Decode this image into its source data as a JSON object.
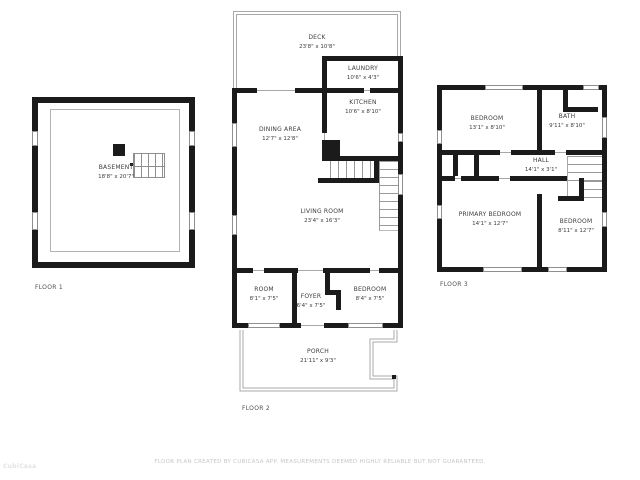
{
  "floors": [
    {
      "label": "FLOOR 1",
      "rooms": [
        {
          "name": "BASEMENT",
          "dims": "18'8\" x 20'7\""
        }
      ]
    },
    {
      "label": "FLOOR 2",
      "rooms": [
        {
          "name": "DECK",
          "dims": "23'8\" x 10'8\""
        },
        {
          "name": "LAUNDRY",
          "dims": "10'6\" x 4'3\""
        },
        {
          "name": "KITCHEN",
          "dims": "10'6\" x 8'10\""
        },
        {
          "name": "DINING AREA",
          "dims": "12'7\" x 12'8\""
        },
        {
          "name": "LIVING ROOM",
          "dims": "23'4\" x 16'3\""
        },
        {
          "name": "ROOM",
          "dims": "8'1\" x 7'5\""
        },
        {
          "name": "FOYER",
          "dims": "6'4\" x 7'5\""
        },
        {
          "name": "BEDROOM",
          "dims": "8'4\" x 7'5\""
        },
        {
          "name": "PORCH",
          "dims": "21'11\" x 9'3\""
        }
      ]
    },
    {
      "label": "FLOOR 3",
      "rooms": [
        {
          "name": "BEDROOM",
          "dims": "13'1\" x 8'10\""
        },
        {
          "name": "BATH",
          "dims": "9'11\" x 8'10\""
        },
        {
          "name": "HALL",
          "dims": "14'1\" x 3'1\""
        },
        {
          "name": "PRIMARY BEDROOM",
          "dims": "14'1\" x 12'7\""
        },
        {
          "name": "BEDROOM",
          "dims": "8'11\" x 12'7\""
        }
      ]
    }
  ],
  "footer": {
    "disclaimer": "FLOOR PLAN CREATED BY CUBICASA APP. MEASUREMENTS DEEMED HIGHLY RELIABLE BUT NOT GUARANTEED."
  },
  "watermark": "CubiCasa",
  "colors": {
    "wall": "#1b1b1b",
    "thin_line": "#a8a8a8",
    "label_text": "#3d3d3d",
    "footer_text": "#c6c6c6",
    "background": "#ffffff"
  }
}
